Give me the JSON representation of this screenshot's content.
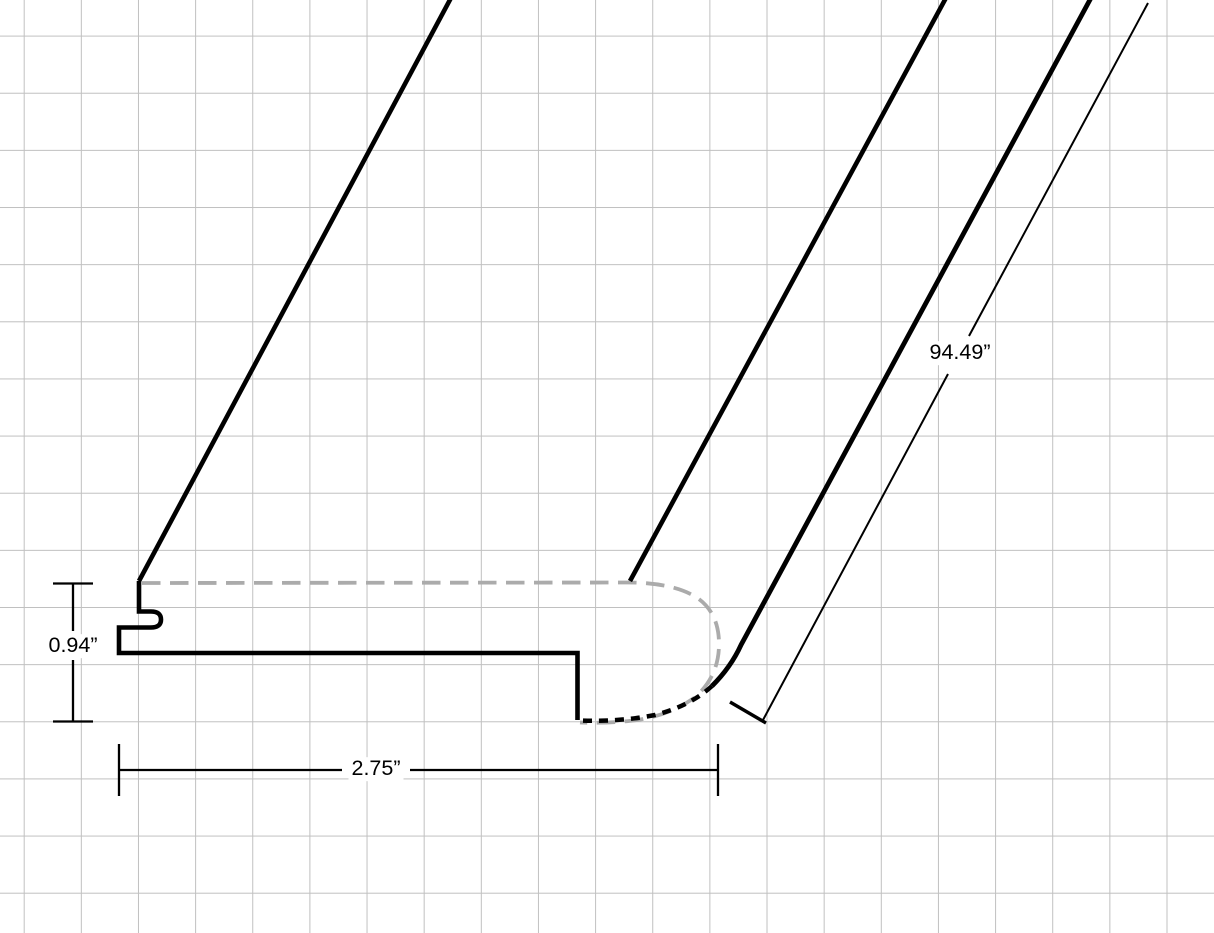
{
  "labels": {
    "thickness": "0.94”",
    "width": "2.75”",
    "length": "94.49”"
  },
  "colors": {
    "outline": "#000000",
    "hidden_edge": "#ababab",
    "grid_line": "#c0c0c0",
    "background": "#ffffff",
    "dimension_line": "#000000",
    "label_text": "#000000"
  }
}
